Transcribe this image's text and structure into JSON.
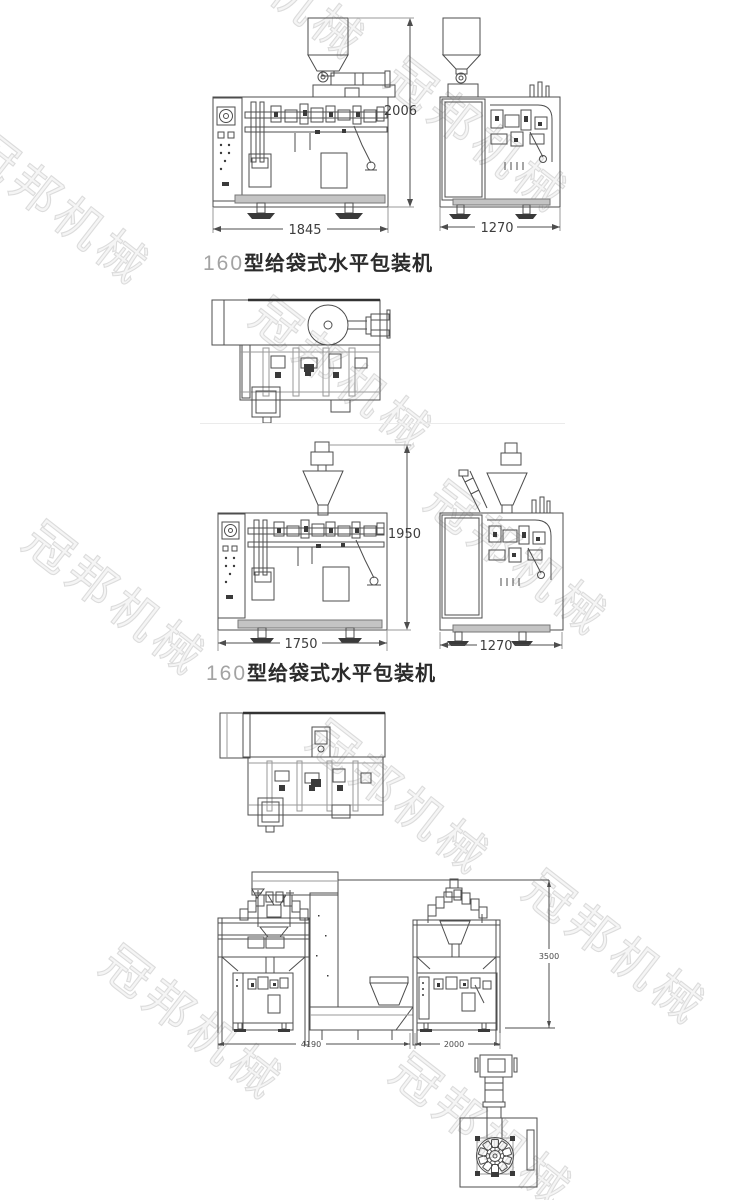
{
  "watermark": {
    "text": "冠邦机械"
  },
  "machine1": {
    "caption": {
      "model": "160",
      "name": "型给袋式水平包装机"
    },
    "front_view": {
      "height_mm": "2006",
      "width_mm": "1845"
    },
    "side_view": {
      "width_mm": "1270"
    }
  },
  "machine2": {
    "caption": {
      "model": "160",
      "name": "型给袋式水平包装机"
    },
    "front_view": {
      "height_mm": "1950",
      "width_mm": "1750"
    },
    "side_view": {
      "width_mm": "1270"
    }
  },
  "production_line": {
    "total_width_mm": "4190",
    "machine_width_mm": "2000",
    "total_height_mm": "3500"
  }
}
